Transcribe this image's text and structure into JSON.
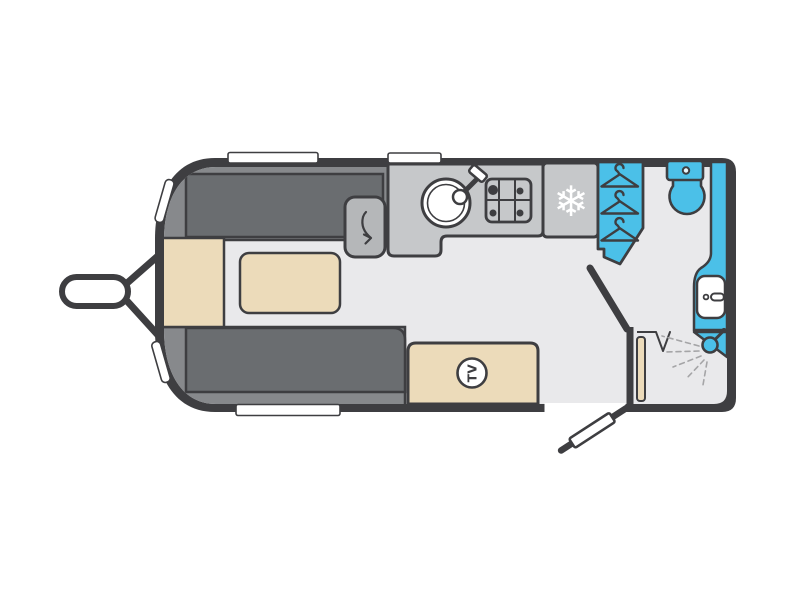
{
  "diagram": {
    "type": "floorplan",
    "subject": "touring caravan layout, top-down view"
  },
  "palette": {
    "wall": "#3e3e41",
    "floor": "#e9e9eb",
    "sofa_dark": "#6a6d70",
    "sofa_light": "#87898c",
    "cream": "#ecdbba",
    "counter": "#c6c8ca",
    "flap": "#b5b7b9",
    "blue": "#4bc0e8",
    "white": "#ffffff",
    "spray": "#a5a5a7"
  },
  "labels": {
    "tv": "TV"
  },
  "icons": {
    "snowflake": "❄"
  },
  "features": [
    "tow-hitch",
    "front-chest",
    "front-sofa",
    "rear-sofa",
    "table",
    "worktop-flap",
    "kitchen-worktop",
    "sink",
    "hob",
    "fridge",
    "wardrobe",
    "toilet",
    "washbasin",
    "shower",
    "tv-unit",
    "washroom-partition",
    "washroom-door",
    "entrance-door",
    "windows"
  ]
}
